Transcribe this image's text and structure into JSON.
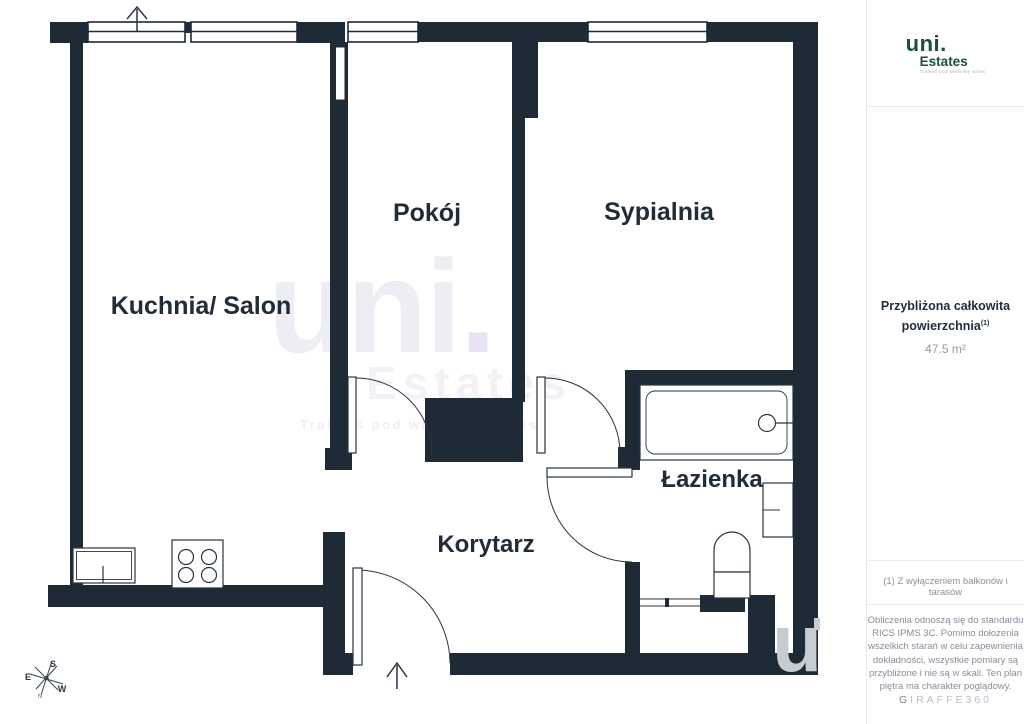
{
  "plan": {
    "rooms": {
      "kitchen_living": "Kuchnia/ Salon",
      "room": "Pokój",
      "bedroom": "Sypialnia",
      "bathroom": "Łazienka",
      "corridor": "Korytarz"
    },
    "compass": {
      "e": "E",
      "s": "S",
      "w": "W",
      "n": "N"
    },
    "watermark": {
      "brand": "uni",
      "dot": ".",
      "sub": "Estates",
      "tagline": "Trafiłeś pod właściwy adres",
      "corner_letter": "u"
    }
  },
  "sidebar": {
    "logo": {
      "brand": "uni.",
      "sub": "Estates",
      "tagline": "Trafiłeś pod właściwy adres"
    },
    "area": {
      "title_line1": "Przybliżona całkowita",
      "title_line2": "powierzchnia",
      "footnote_ref": "(1)",
      "value": "47.5 m²"
    },
    "footnote": "(1) Z wyłączeniem balkonów i tarasów",
    "disclaimer": [
      "Obliczenia odnoszą się do standardu",
      "RICS IPMS 3C. Pomimo dołożenia",
      "wszelkich starań w celu zapewnienia",
      "dokładności, wszystkie pomiary są",
      "przybliżone i nie są w skali. Ten plan",
      "piętra ma charakter poglądowy."
    ],
    "brand_footer_first": "G",
    "brand_footer_rest": "IRAFFE360"
  },
  "colors": {
    "wall": "#1f2a37",
    "label": "#212c39",
    "logo_green": "#17503d",
    "watermark_light": "#edeef3",
    "watermark_dot": "#e8e2f4",
    "watermark_corner": "#c7ccd3",
    "sidebar_text": "#8a9099"
  }
}
